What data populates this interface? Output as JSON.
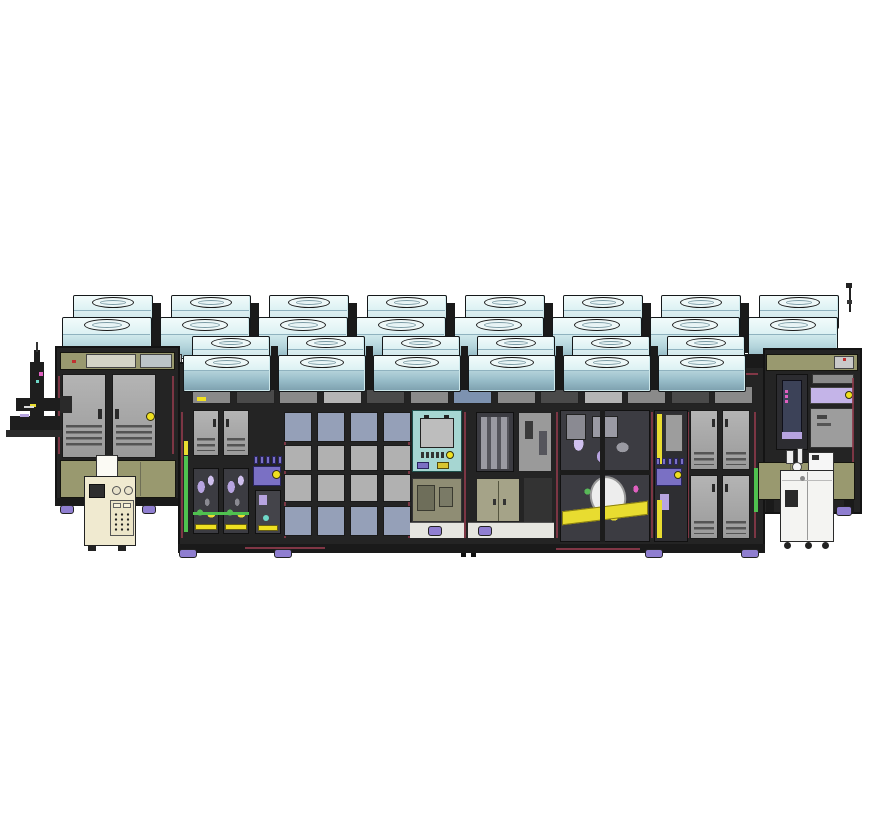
{
  "scene": {
    "background": "#ffffff",
    "description": "3D CAD render of a semiconductor wafer-processing equipment line: two staggered rows of fan-filter units on the roof, a dark-framed enclosure with glazed panels, service doors, process bays, a robot mast on the far left and two utility carts"
  },
  "palette": {
    "outline": "#141414",
    "frame": "#242424",
    "frame_dark": "#1a1a1a",
    "ffu_top": "#f2fbfb",
    "ffu_top_edge": "#dcf1f3",
    "ffu_steel": "#8fb2bf",
    "door_gray": "#a6a6a6",
    "vent": "#545454",
    "olive": "#99996f",
    "olive_dark": "#6e6e56",
    "cream": "#f0ead0",
    "white_panel": "#f4f4f2",
    "win_blue": "#95a0b8",
    "win_gray": "#b1b1b1",
    "win_dark": "#3c3c42",
    "lavender": "#b7a4e0",
    "lavender_light": "#cfc0ee",
    "purple": "#7a70c4",
    "yellow": "#f0e020",
    "teal": "#a6d6d2",
    "teal_dot": "#6fd8c8",
    "green": "#4fc24f",
    "maroon": "#8c3a4a",
    "pink": "#e060c0",
    "red": "#c03030",
    "caster": "#8f7ed0",
    "steel_blue": "#7d92b0",
    "machine": "#8a8a92"
  },
  "ffu": {
    "back_row_count": 8,
    "front_row_count": 6
  },
  "header_windows": {
    "count": 13,
    "shades": [
      "mid",
      "dark",
      "mid",
      "light",
      "dark",
      "mid",
      "blue",
      "mid",
      "dark",
      "light",
      "mid",
      "dark",
      "mid"
    ],
    "accent_cell": 0
  },
  "window_grid": {
    "cols": 4,
    "row_colors": [
      "blue",
      "gray",
      "gray",
      "blue"
    ]
  },
  "doors": {
    "left_module": 2,
    "section_a": 2,
    "right_grid_cols": 2,
    "right_grid_rows": 2
  },
  "indicator_chips": {
    "section_a": 5,
    "bay_f": 5,
    "console_marks": 5
  },
  "casters": {
    "center_count": 4
  }
}
